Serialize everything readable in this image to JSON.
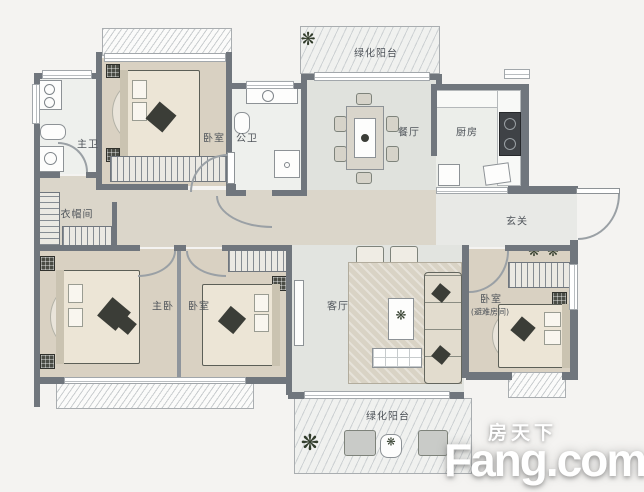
{
  "page": {
    "type": "apartment-floor-plan"
  },
  "watermark": {
    "site_cn": "房天下",
    "site_en": "Fang.com"
  },
  "rooms": {
    "master_bath": {
      "label": "主卫"
    },
    "bedroom_top": {
      "label": "卧室"
    },
    "public_bath": {
      "label": "公卫"
    },
    "dining_room": {
      "label": "餐厅"
    },
    "kitchen": {
      "label": "厨房"
    },
    "foyer": {
      "label": "玄关"
    },
    "closet": {
      "label": "衣帽间"
    },
    "master_bedroom": {
      "label": "主卧"
    },
    "second_bedroom": {
      "label": "卧室"
    },
    "living_room": {
      "label": "客厅"
    },
    "refuge_bedroom": {
      "label": "卧室",
      "sublabel": "(避难房间)"
    },
    "balcony_top": {
      "label": "绿化阳台"
    },
    "balcony_bottom": {
      "label": "绿化阳台"
    }
  },
  "icons": {
    "plant": "❋"
  },
  "colors": {
    "wall": "#70767d",
    "bedroom_floor": "#d9d1c2",
    "wood_floor": "#dbd6ca",
    "dining_floor": "#e0e2dd",
    "living_floor": "#e2e4e0",
    "hall_floor": "#e8e9e6",
    "bath_floor": "#eef0ed",
    "kitchen_floor": "#eceeea",
    "label_text": "#4f545a",
    "plant_green": "#323d2c",
    "watermark": "#ffffff"
  }
}
